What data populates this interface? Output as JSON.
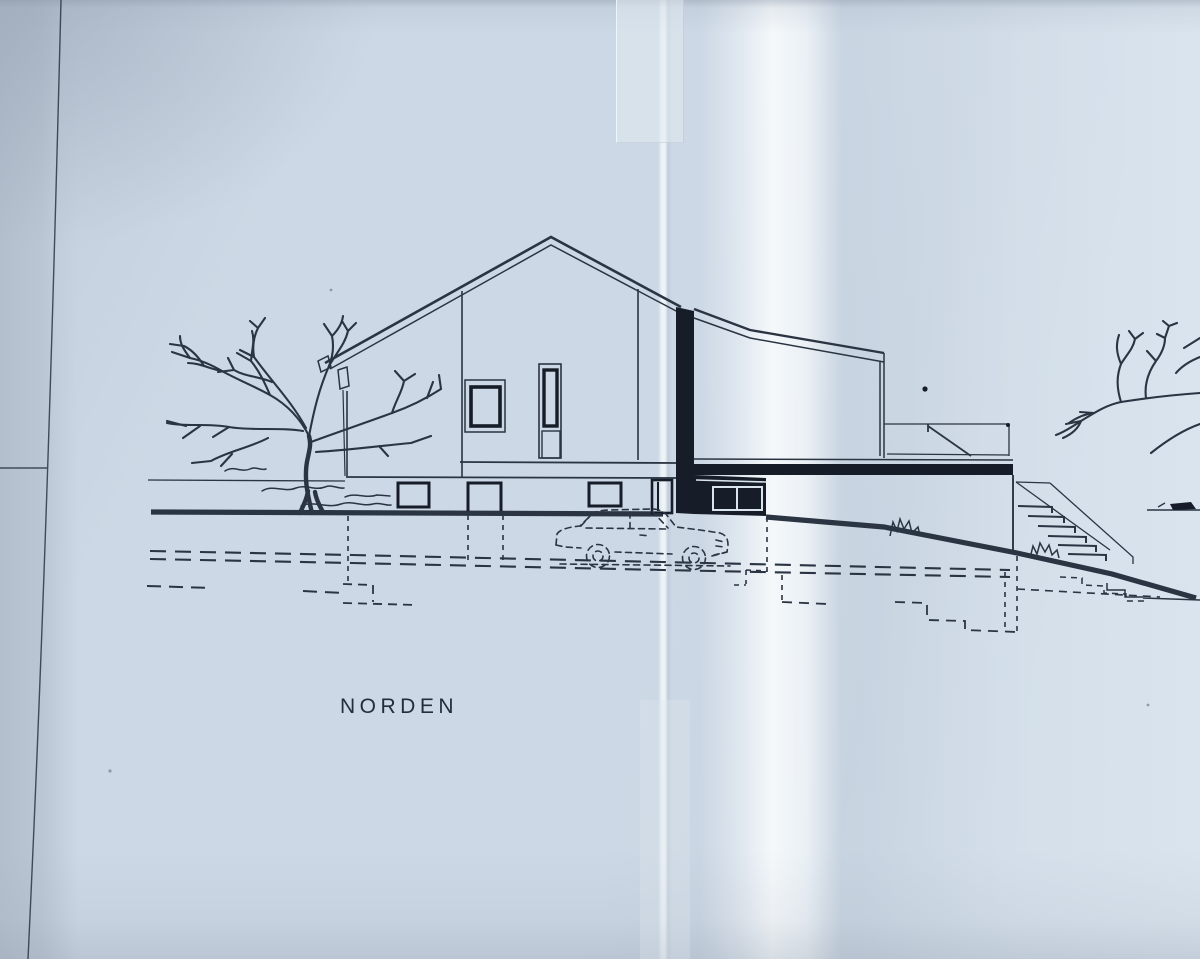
{
  "drawing": {
    "label": "NORDEN",
    "kind": "architectural-elevation-blueprint-photo",
    "elements": [
      "gabled-house",
      "flat-roof-wing",
      "entrance-recess-glazing",
      "terrace-railing",
      "exterior-stairs",
      "ground-line",
      "slope-line",
      "foundation-dashed-lines",
      "bare-tree-left",
      "bare-tree-right",
      "car-sketch",
      "shrub-sketches",
      "paper-fold",
      "tape-strip"
    ]
  },
  "colors": {
    "paper": "#ccd8e5",
    "paper_bright": "#eff3f6",
    "paper_edge": "#b6c2d0",
    "ink": "#2a3442",
    "ink_dark": "#161d28",
    "label_ink": "#232d3b",
    "white_line": "#dae4ed"
  }
}
